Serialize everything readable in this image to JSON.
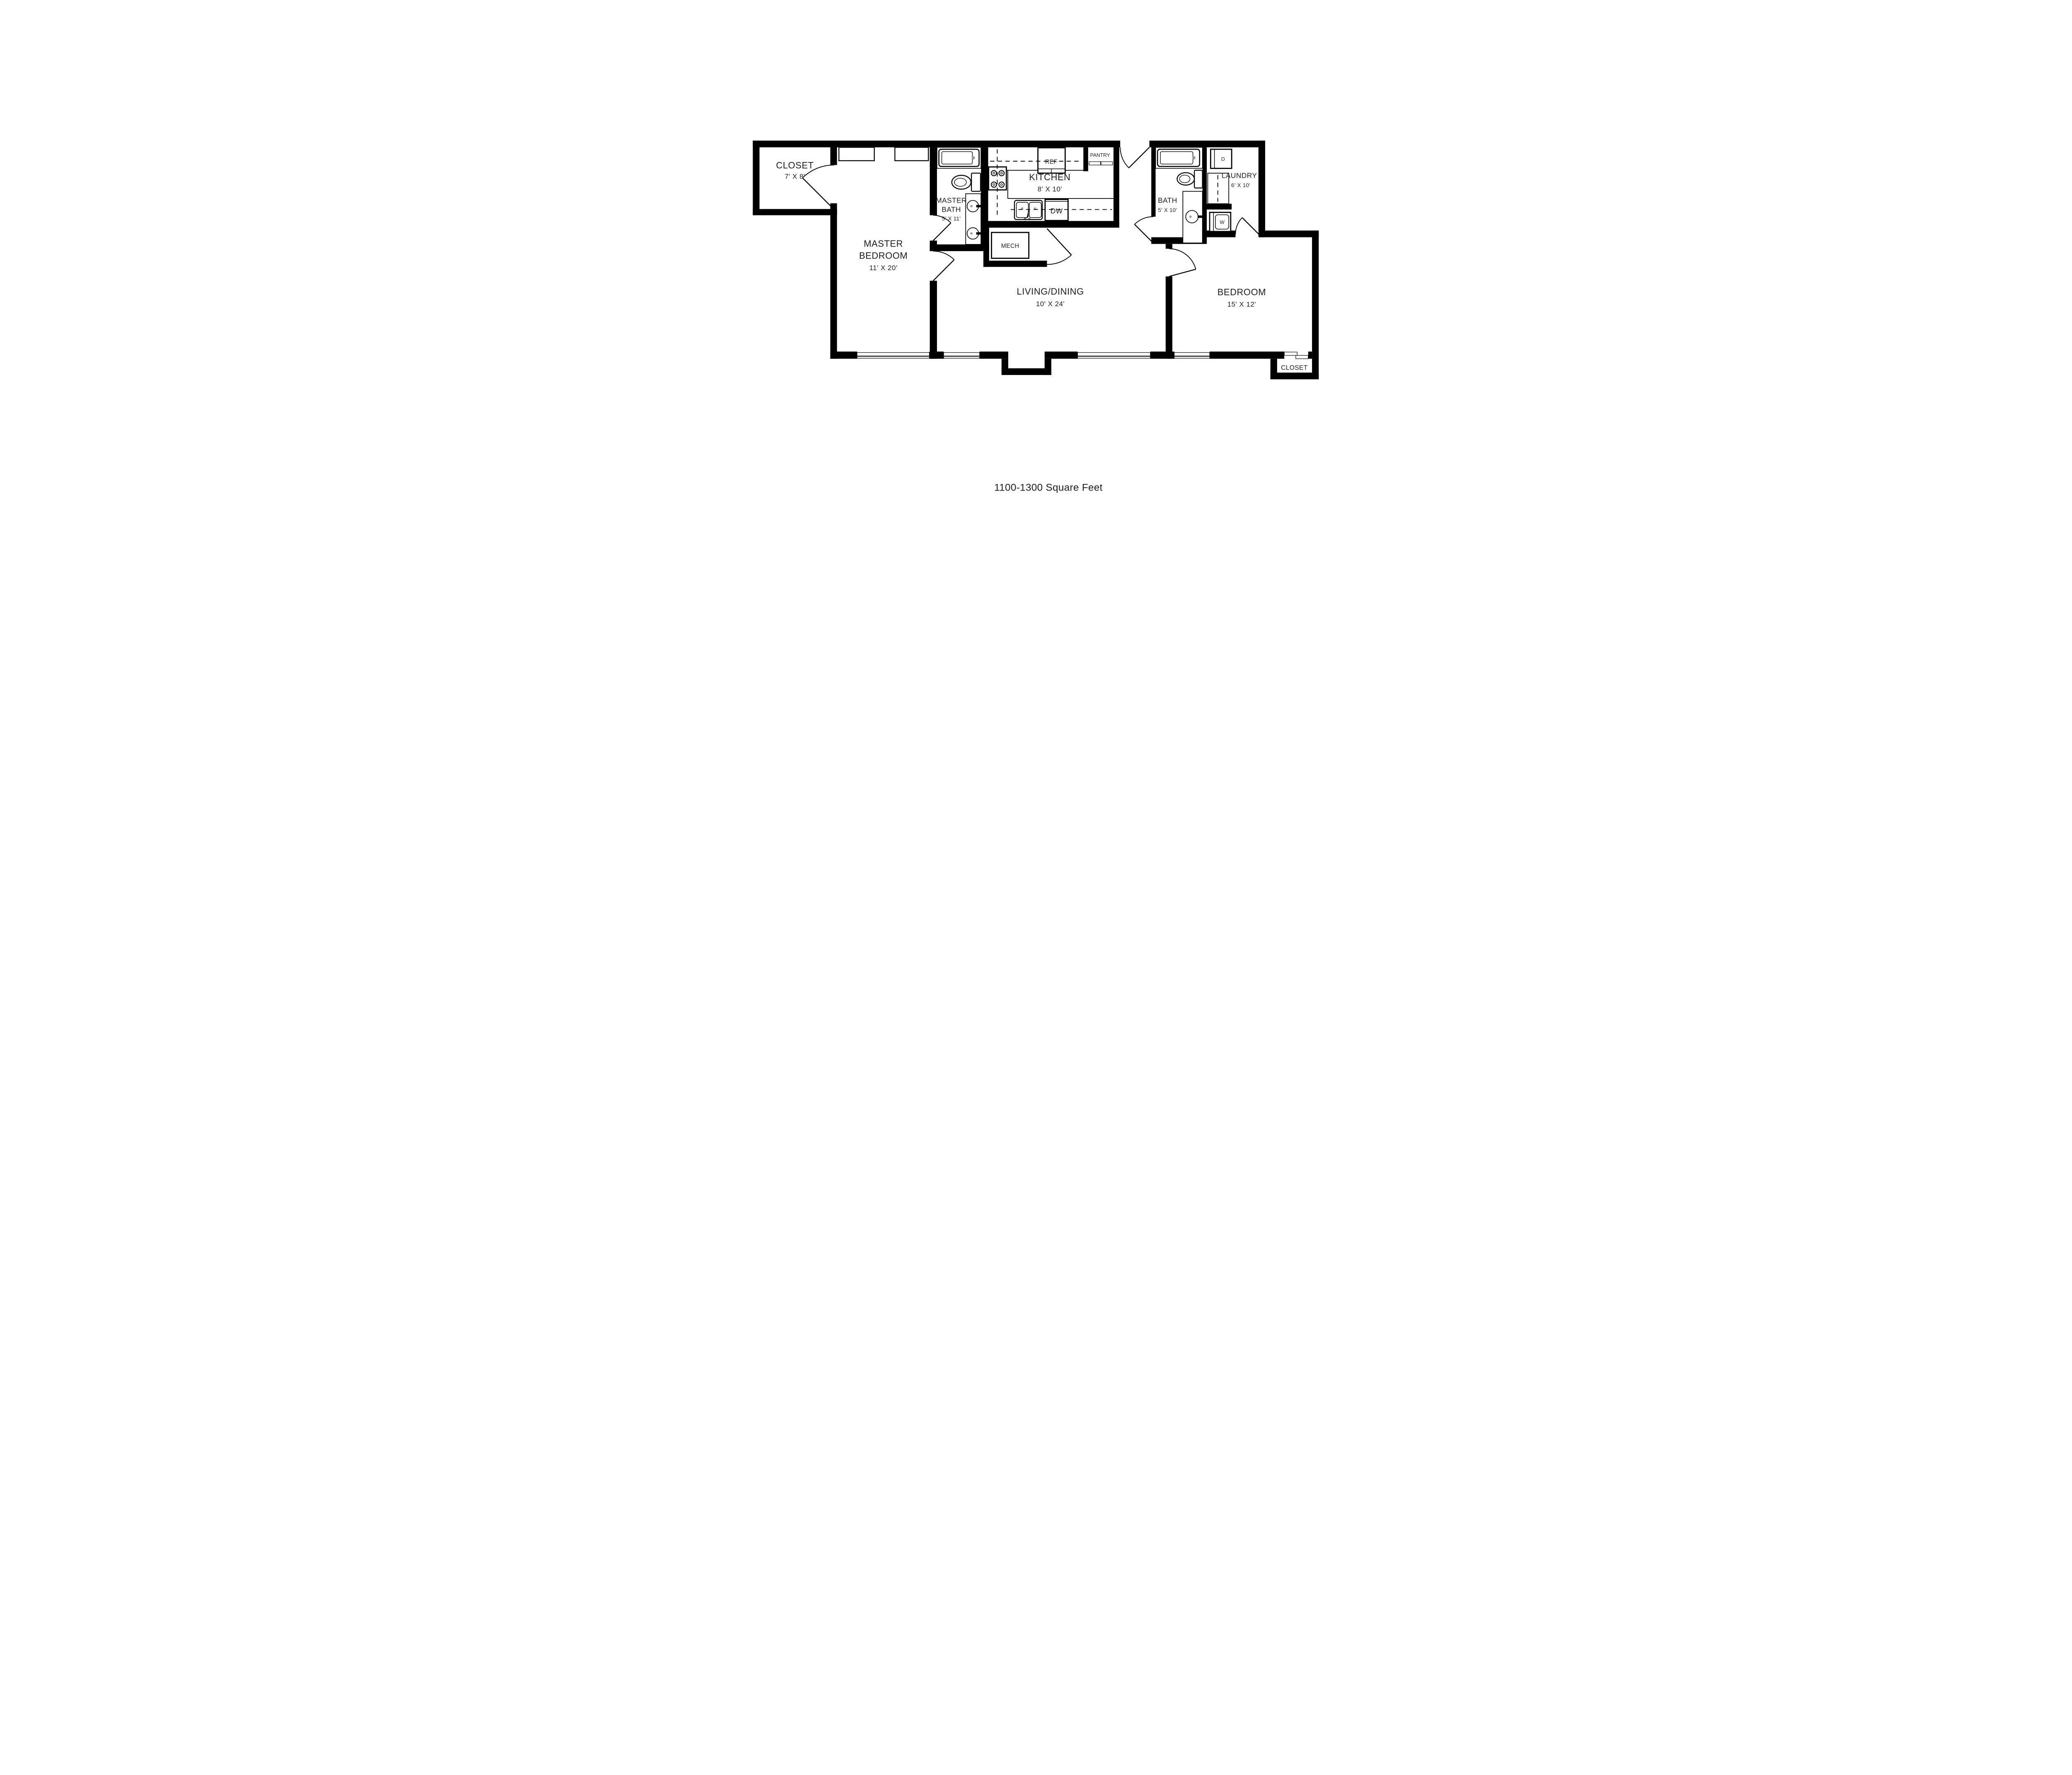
{
  "caption": "1100-1300 Square Feet",
  "rooms": {
    "master_closet": {
      "name": "CLOSET",
      "dims": "7' X 8'"
    },
    "master_bedroom": {
      "name1": "MASTER",
      "name2": "BEDROOM",
      "dims": "11' X 20'"
    },
    "master_bath": {
      "name1": "MASTER",
      "name2": "BATH",
      "dims": "5' X 11'"
    },
    "kitchen": {
      "name": "KITCHEN",
      "dims": "8' X 10'"
    },
    "living_dining": {
      "name": "LIVING/DINING",
      "dims": "10' X 24'"
    },
    "bath": {
      "name": "BATH",
      "dims": "5' X 10'"
    },
    "laundry": {
      "name": "LAUNDRY",
      "dims": "6' X 10'"
    },
    "bedroom": {
      "name": "BEDROOM",
      "dims": "15' X 12'"
    },
    "bedroom_closet": {
      "name": "CLOSET"
    }
  },
  "labels": {
    "refrigerator": "REF",
    "pantry": "PANTRY",
    "dishwasher": "DW",
    "mechanical": "MECH",
    "dryer": "D",
    "washer": "W"
  },
  "colors": {
    "wall": "#000000",
    "text": "#1c1c1c",
    "drain_gray": "#9b9b9b",
    "background": "#ffffff"
  }
}
